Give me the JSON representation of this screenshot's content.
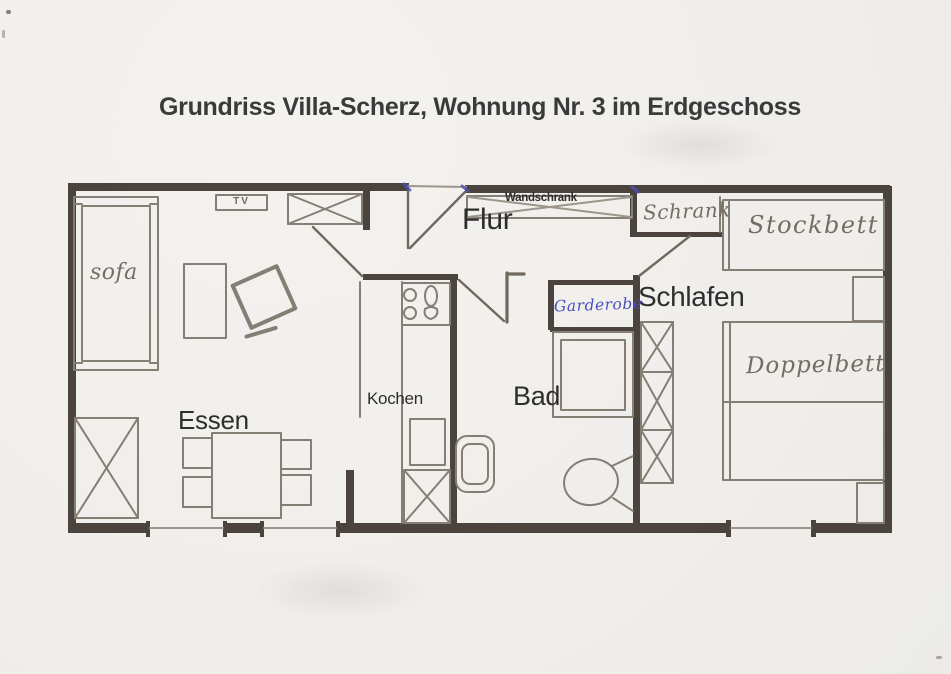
{
  "title": "Grundriss Villa-Scherz, Wohnung Nr. 3 im Erdgeschoss",
  "floorplan": {
    "living_room": {
      "dining_label": "Essen",
      "sofa_label": "sofa",
      "tv_label": "TV"
    },
    "kitchen": {
      "label": "Kochen"
    },
    "hallway": {
      "label": "Flur",
      "closet_label": "Wandschrank"
    },
    "bathroom": {
      "label": "Bad"
    },
    "wardrobe_nook": {
      "label": "Garderobe"
    },
    "bedroom": {
      "label": "Schlafen",
      "cabinet_label": "Schrank",
      "bunkbed_label": "Stockbett",
      "doublebed_label": "Doppelbett"
    }
  },
  "colors": {
    "paper": "#f1efec",
    "wall": "#4a433e",
    "pencil": "#847e75",
    "printed_text": "#2e2e2e",
    "handwriting": "#736d64",
    "ink_blue": "#4a50bd"
  }
}
